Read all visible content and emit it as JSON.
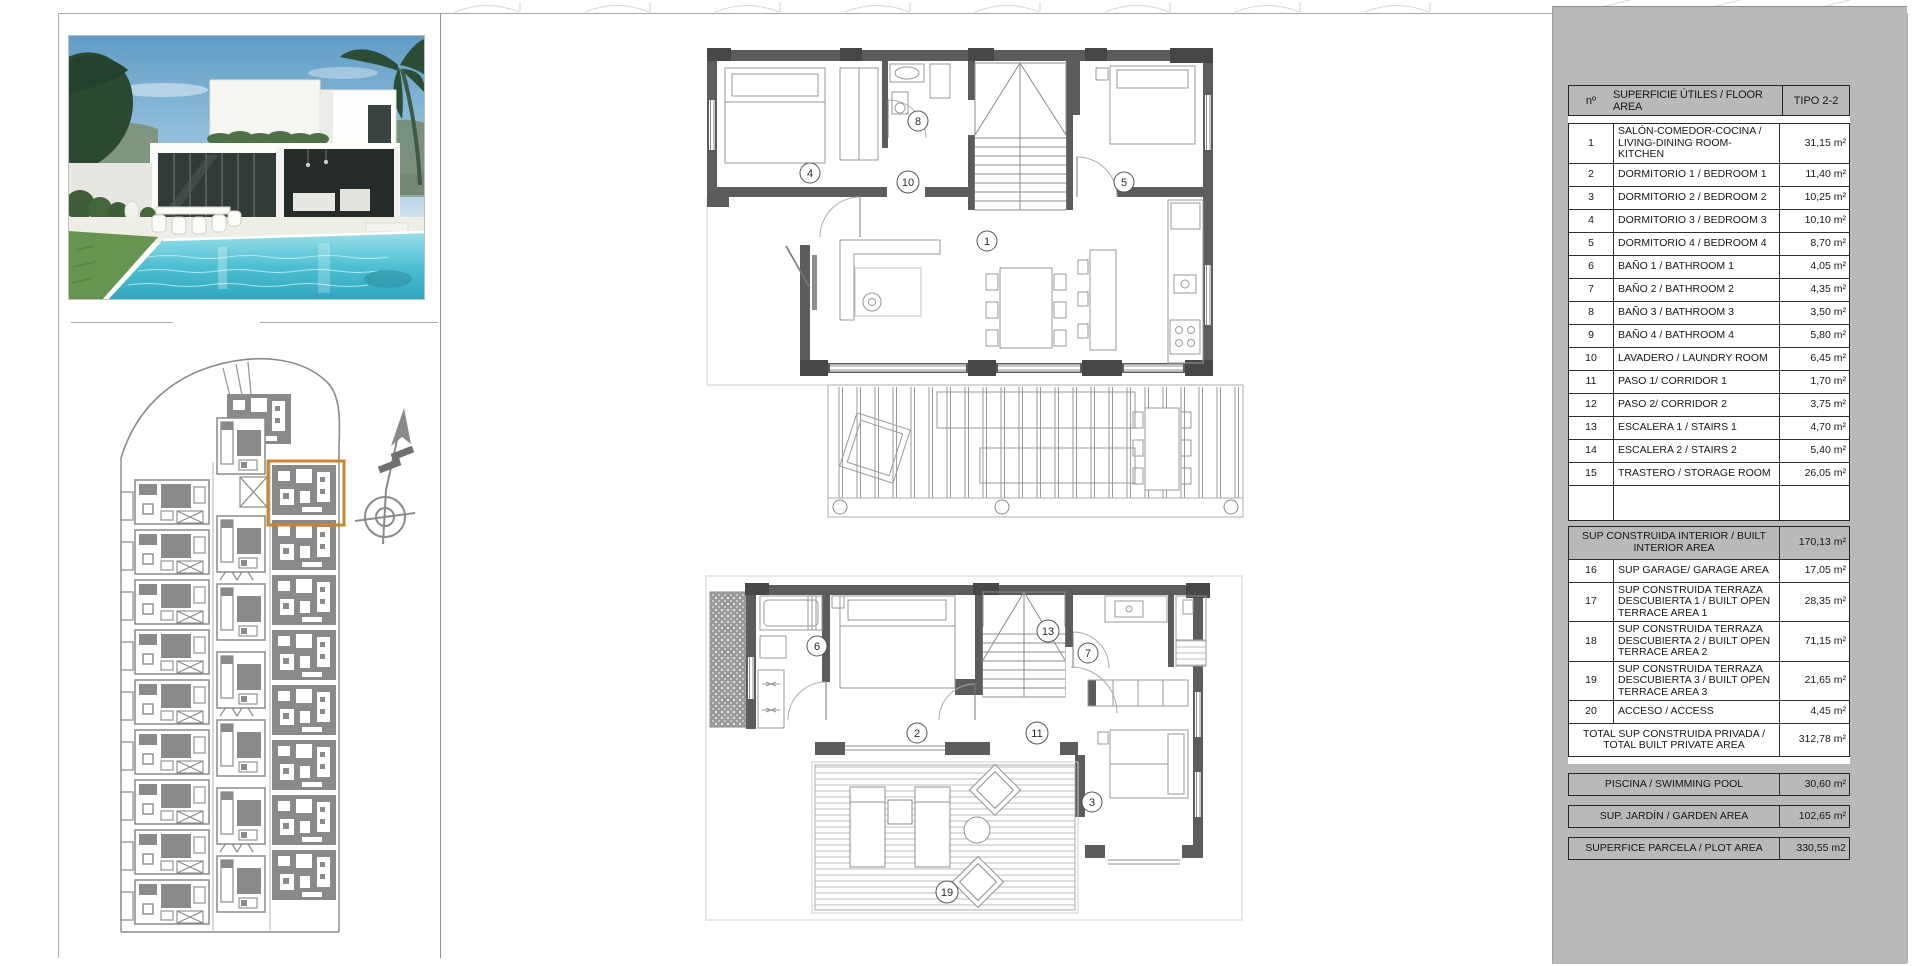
{
  "colors": {
    "panel_gray": "#b9b9b9",
    "wall_gray": "#5c5c5c",
    "site_gray": "#8a8a8a",
    "highlight_orange": "#c8872e",
    "pool_blue": "#41b5cb",
    "sky_blue": "#6fa9cf"
  },
  "plans": {
    "upper": {
      "r1": "1",
      "r4": "4",
      "r5": "5",
      "r8": "8",
      "r10": "10"
    },
    "lower": {
      "r2": "2",
      "r3": "3",
      "r6": "6",
      "r7": "7",
      "r11": "11",
      "r13": "13",
      "r19": "19"
    }
  },
  "area_table": {
    "header": {
      "num": "nº",
      "label": "SUPERFICIE ÚTILES / FLOOR AREA",
      "type": "TIPO 2-2"
    },
    "rows": [
      {
        "num": "1",
        "label": "SALÓN-COMEDOR-COCINA / LIVING-DINING ROOM-KITCHEN",
        "value": "31,15 m²"
      },
      {
        "num": "2",
        "label": "DORMITORIO 1 / BEDROOM 1",
        "value": "11,40 m²"
      },
      {
        "num": "3",
        "label": "DORMITORIO 2 / BEDROOM 2",
        "value": "10,25 m²"
      },
      {
        "num": "4",
        "label": "DORMITORIO 3 / BEDROOM 3",
        "value": "10,10 m²"
      },
      {
        "num": "5",
        "label": "DORMITORIO 4 / BEDROOM 4",
        "value": "8,70 m²"
      },
      {
        "num": "6",
        "label": "BAÑO 1 / BATHROOM 1",
        "value": "4,05 m²"
      },
      {
        "num": "7",
        "label": "BAÑO 2 / BATHROOM 2",
        "value": "4,35 m²"
      },
      {
        "num": "8",
        "label": "BAÑO 3 / BATHROOM 3",
        "value": "3,50 m²"
      },
      {
        "num": "9",
        "label": "BAÑO 4 / BATHROOM 4",
        "value": "5,80 m²"
      },
      {
        "num": "10",
        "label": "LAVADERO / LAUNDRY ROOM",
        "value": "6,45 m²"
      },
      {
        "num": "11",
        "label": "PASO 1/ CORRIDOR 1",
        "value": "1,70 m²"
      },
      {
        "num": "12",
        "label": "PASO 2/ CORRIDOR 2",
        "value": "3,75 m²"
      },
      {
        "num": "13",
        "label": "ESCALERA 1 / STAIRS 1",
        "value": "4,70 m²"
      },
      {
        "num": "14",
        "label": "ESCALERA 2 / STAIRS 2",
        "value": "5,40 m²"
      },
      {
        "num": "15",
        "label": "TRASTERO / STORAGE ROOM",
        "value": "26,05 m²"
      },
      {
        "num": "",
        "label": "",
        "value": "",
        "empty": true
      }
    ],
    "built_rows": [
      {
        "label": "SUP CONSTRUIDA INTERIOR / BUILT INTERIOR AREA",
        "value": "170,13 m²",
        "span": true,
        "kind": "section"
      },
      {
        "num": "16",
        "label": "SUP GARAGE/ GARAGE AREA",
        "value": "17,05 m²"
      },
      {
        "num": "17",
        "label": "SUP CONSTRUIDA TERRAZA DESCUBIERTA 1 / BUILT OPEN TERRACE AREA 1",
        "value": "28,35 m²"
      },
      {
        "num": "18",
        "label": "SUP CONSTRUIDA TERRAZA DESCUBIERTA 2 / BUILT OPEN TERRACE AREA 2",
        "value": "71,15 m²"
      },
      {
        "num": "19",
        "label": "SUP CONSTRUIDA TERRAZA DESCUBIERTA 3 / BUILT OPEN TERRACE AREA 3",
        "value": "21,65 m²"
      },
      {
        "num": "20",
        "label": "ACCESO / ACCESS",
        "value": "4,45 m²"
      },
      {
        "label": "TOTAL SUP CONSTRUIDA PRIVADA / TOTAL BUILT PRIVATE AREA",
        "value": "312,78 m²",
        "span": true,
        "kind": "total"
      }
    ],
    "summary_rows": [
      {
        "label": "PISCINA / SWIMMING POOL",
        "value": "30,60 m²",
        "span": true,
        "kind": "section"
      },
      {
        "label": "SUP. JARDÍN / GARDEN AREA",
        "value": "102,65 m²",
        "span": true,
        "kind": "section"
      },
      {
        "label": "SUPERFICE PARCELA / PLOT AREA",
        "value": "330,55 m2",
        "span": true,
        "kind": "section"
      }
    ]
  }
}
